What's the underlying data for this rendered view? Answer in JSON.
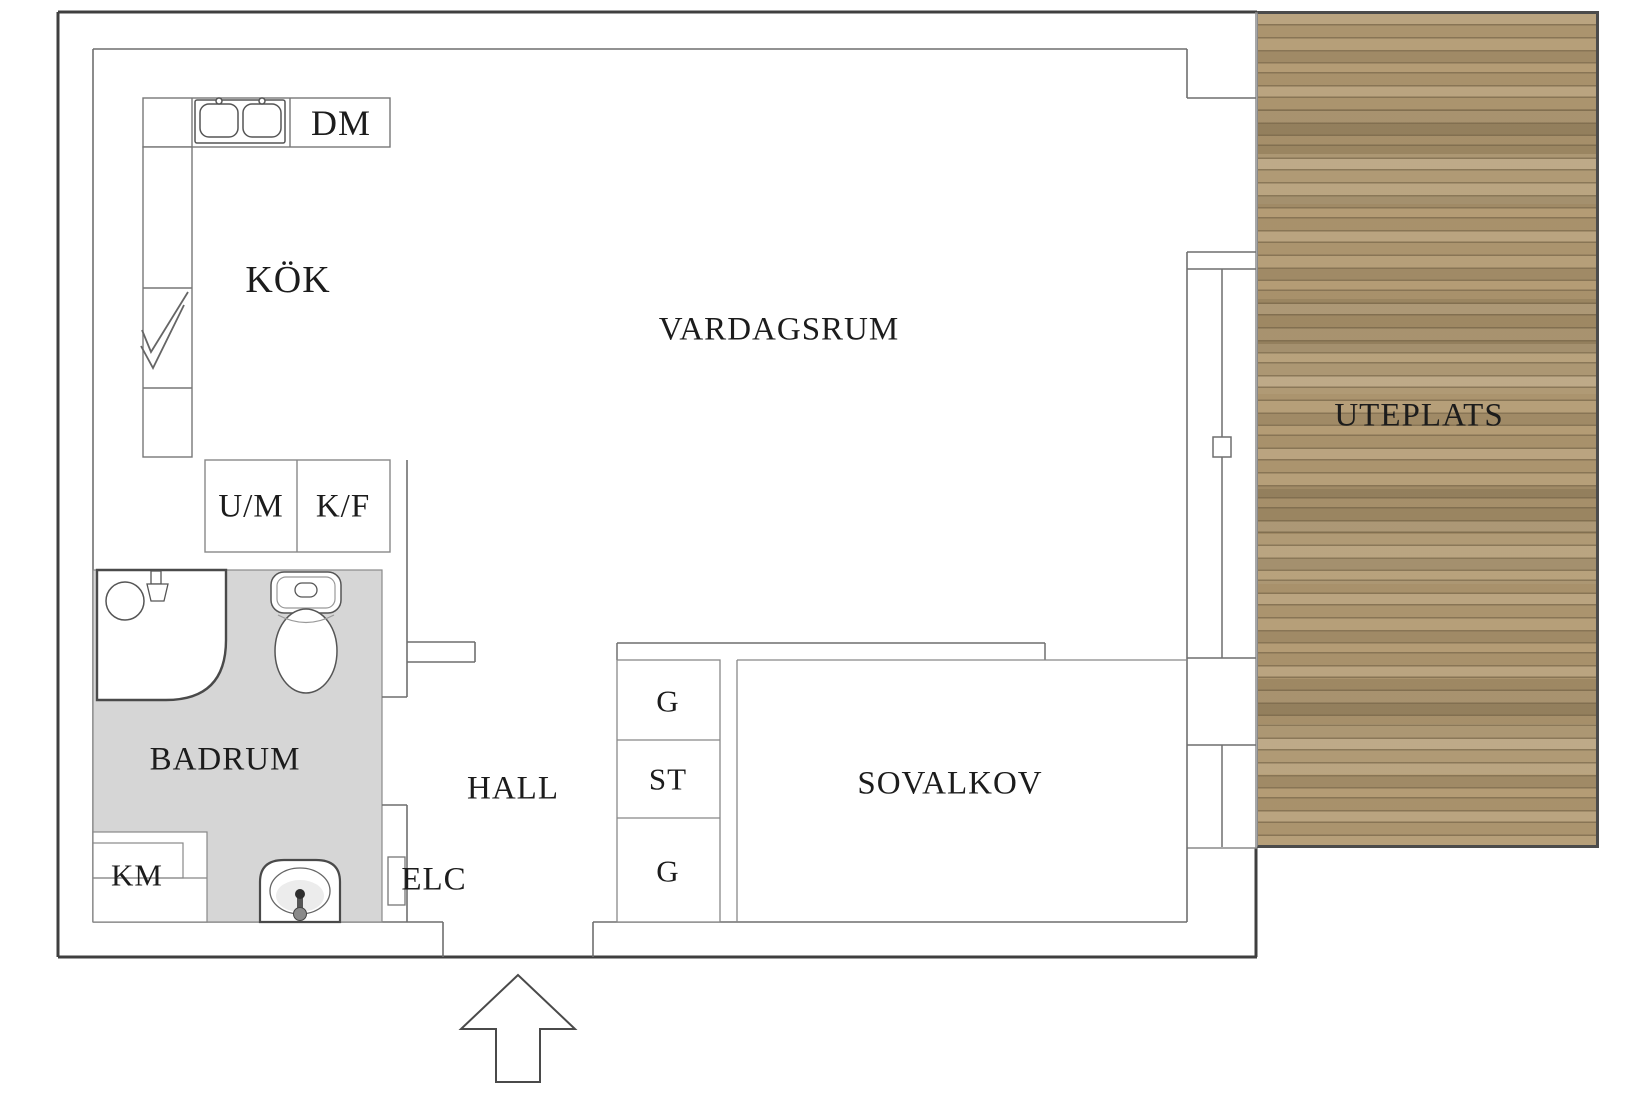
{
  "colors": {
    "background": "#ffffff",
    "wall_outline": "#3f3f3f",
    "inner_line": "#6f6f6f",
    "bathroom_floor": "#d6d6d6",
    "deck_wood_base": "#b29a72",
    "deck_border": "#4b4b4b",
    "label_text": "#1c1c1c"
  },
  "room_labels": {
    "kitchen": "KÖK",
    "living_room": "VARDAGSRUM",
    "patio": "UTEPLATS",
    "bathroom": "BADRUM",
    "hall": "HALL",
    "sleeping_alcove": "SOVALKOV"
  },
  "fixture_labels": {
    "dishwasher": "DM",
    "washer_dryer": "U/M",
    "fridge_freezer": "K/F",
    "washing_machine": "KM",
    "electrical_cabinet": "ELC",
    "wardrobe_top": "G",
    "cleaning_closet": "ST",
    "wardrobe_bottom": "G"
  }
}
